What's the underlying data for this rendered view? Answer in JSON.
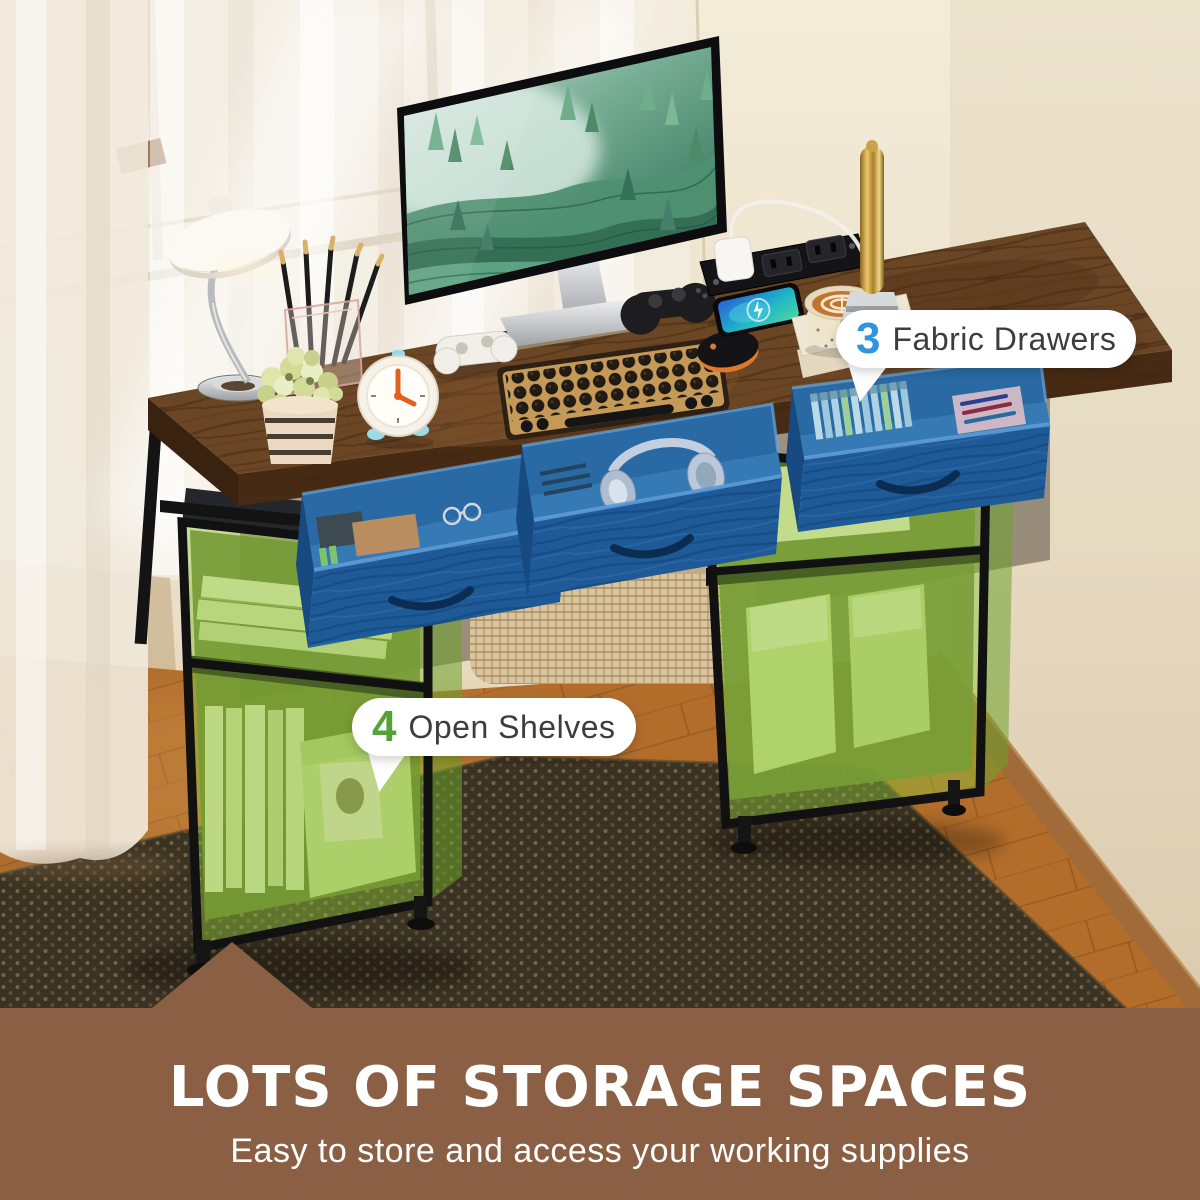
{
  "callouts": {
    "fabric_drawers": {
      "number": "3",
      "label": "Fabric Drawers",
      "number_color": "#3095dd",
      "pill_bg": "#ffffff",
      "label_color": "#3d3d3d"
    },
    "open_shelves": {
      "number": "4",
      "label": "Open Shelves",
      "number_color": "#57a238",
      "pill_bg": "#ffffff",
      "label_color": "#3d3d3d"
    }
  },
  "banner": {
    "title": "LOTS OF STORAGE SPACES",
    "subtitle": "Easy to store and access your working supplies",
    "background_color": "#8a5f44",
    "text_color": "#ffffff"
  },
  "scene": {
    "highlight_colors": {
      "drawers_blue": "#1d5a97",
      "shelves_green": "#8fc43c"
    },
    "room_colors": {
      "wall": "#e9dfc9",
      "curtain": "#f6f1e7",
      "wood_floor": "#b26d2b",
      "rug": "#3a3222",
      "desk_wood": "#6b4625",
      "frame_black": "#141414"
    }
  }
}
